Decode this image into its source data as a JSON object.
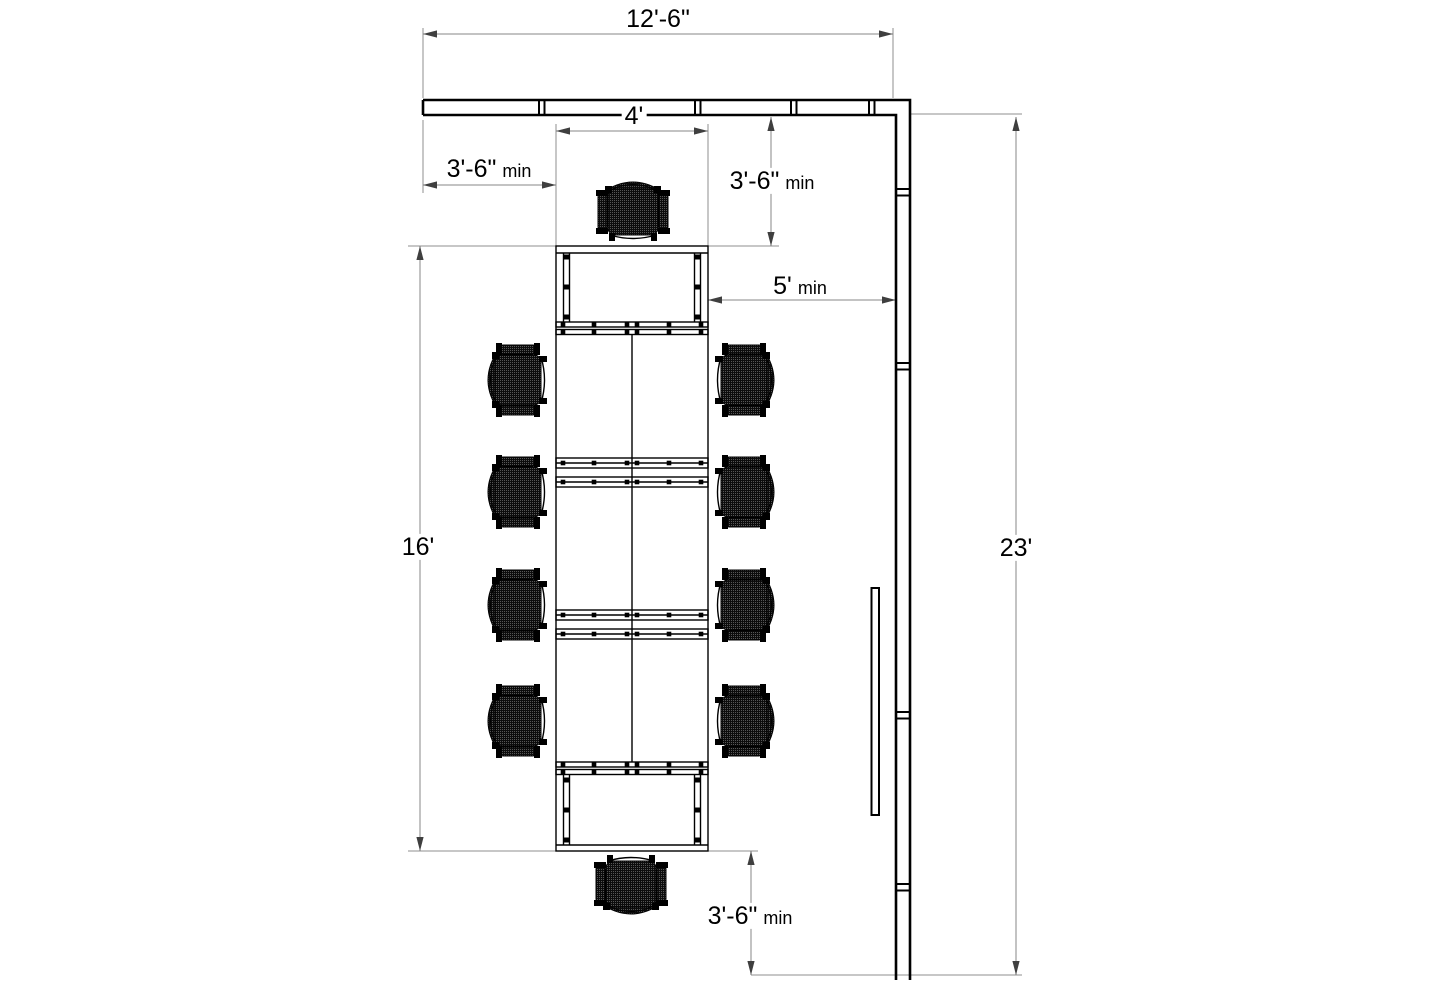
{
  "dimensions": {
    "wall_width": {
      "value": "12'-6\""
    },
    "table_width": {
      "value": "4'"
    },
    "left_clearance": {
      "value": "3'-6\"",
      "suffix": "min"
    },
    "right_clearance": {
      "value": "3'-6\"",
      "suffix": "min"
    },
    "side_aisle": {
      "value": "5'",
      "suffix": "min"
    },
    "table_length": {
      "value": "16'"
    },
    "room_depth": {
      "value": "23'"
    },
    "bottom_clearance": {
      "value": "3'-6\"",
      "suffix": "min"
    }
  },
  "colors": {
    "background": "#ffffff",
    "object_line": "#000000",
    "dimension_line": "#878787"
  },
  "furniture": {
    "chair_count": 10,
    "chairs": [
      {
        "x": 633,
        "y": 205,
        "rot": 0
      },
      {
        "x": 631,
        "y": 891,
        "rot": 180
      },
      {
        "x": 511,
        "y": 380,
        "rot": 270
      },
      {
        "x": 511,
        "y": 492,
        "rot": 270
      },
      {
        "x": 511,
        "y": 605,
        "rot": 270
      },
      {
        "x": 511,
        "y": 721,
        "rot": 270
      },
      {
        "x": 751,
        "y": 380,
        "rot": 90
      },
      {
        "x": 751,
        "y": 492,
        "rot": 90
      },
      {
        "x": 751,
        "y": 605,
        "rot": 90
      },
      {
        "x": 751,
        "y": 721,
        "rot": 90
      }
    ]
  }
}
